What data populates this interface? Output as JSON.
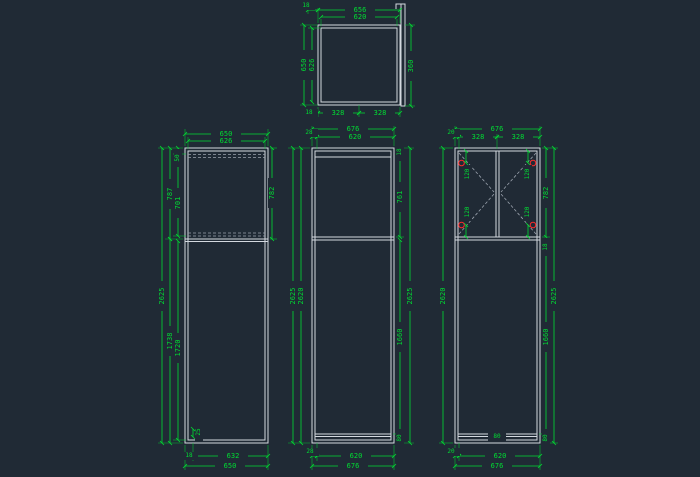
{
  "canvas": {
    "background": "#202a35",
    "object_line_color": "#d4d9e0",
    "hidden_line_color": "#9aa2ad",
    "dimension_color": "#00dd33",
    "hinge_marker_color": "#ff2b2b"
  },
  "views": {
    "plan": {
      "dims": {
        "t18": "18",
        "w656": "656",
        "w620": "620",
        "d650": "650",
        "d626": "626",
        "h360": "360",
        "b18": "18",
        "b328a": "328",
        "b328b": "328"
      }
    },
    "left": {
      "dims": {
        "t650": "650",
        "t626": "626",
        "s50": "50",
        "v787": "787",
        "v701": "701",
        "v2625": "2625",
        "v1738": "1738",
        "v1720": "1720",
        "r782": "782",
        "c25": "25",
        "b18": "18",
        "b632": "632",
        "b650": "650"
      }
    },
    "middle": {
      "dims": {
        "t676": "676",
        "t28": "28",
        "t620": "620",
        "l2625": "2625",
        "l2620": "2620",
        "r18": "18",
        "r761": "761",
        "r1660": "1660",
        "r80": "80",
        "r2625": "2625",
        "b28": "28",
        "b620": "620",
        "b676": "676"
      }
    },
    "right": {
      "dims": {
        "t676": "676",
        "t20": "20",
        "t328a": "328",
        "t328b": "328",
        "l2620": "2620",
        "h120_tl": "120",
        "h120_tr": "120",
        "h120_bl": "120",
        "h120_br": "120",
        "r782": "782",
        "r18": "18",
        "r1660": "1660",
        "r80": "80",
        "r2625": "2625",
        "rail80": "80",
        "b20": "20",
        "b620": "620",
        "b676": "676"
      }
    }
  }
}
